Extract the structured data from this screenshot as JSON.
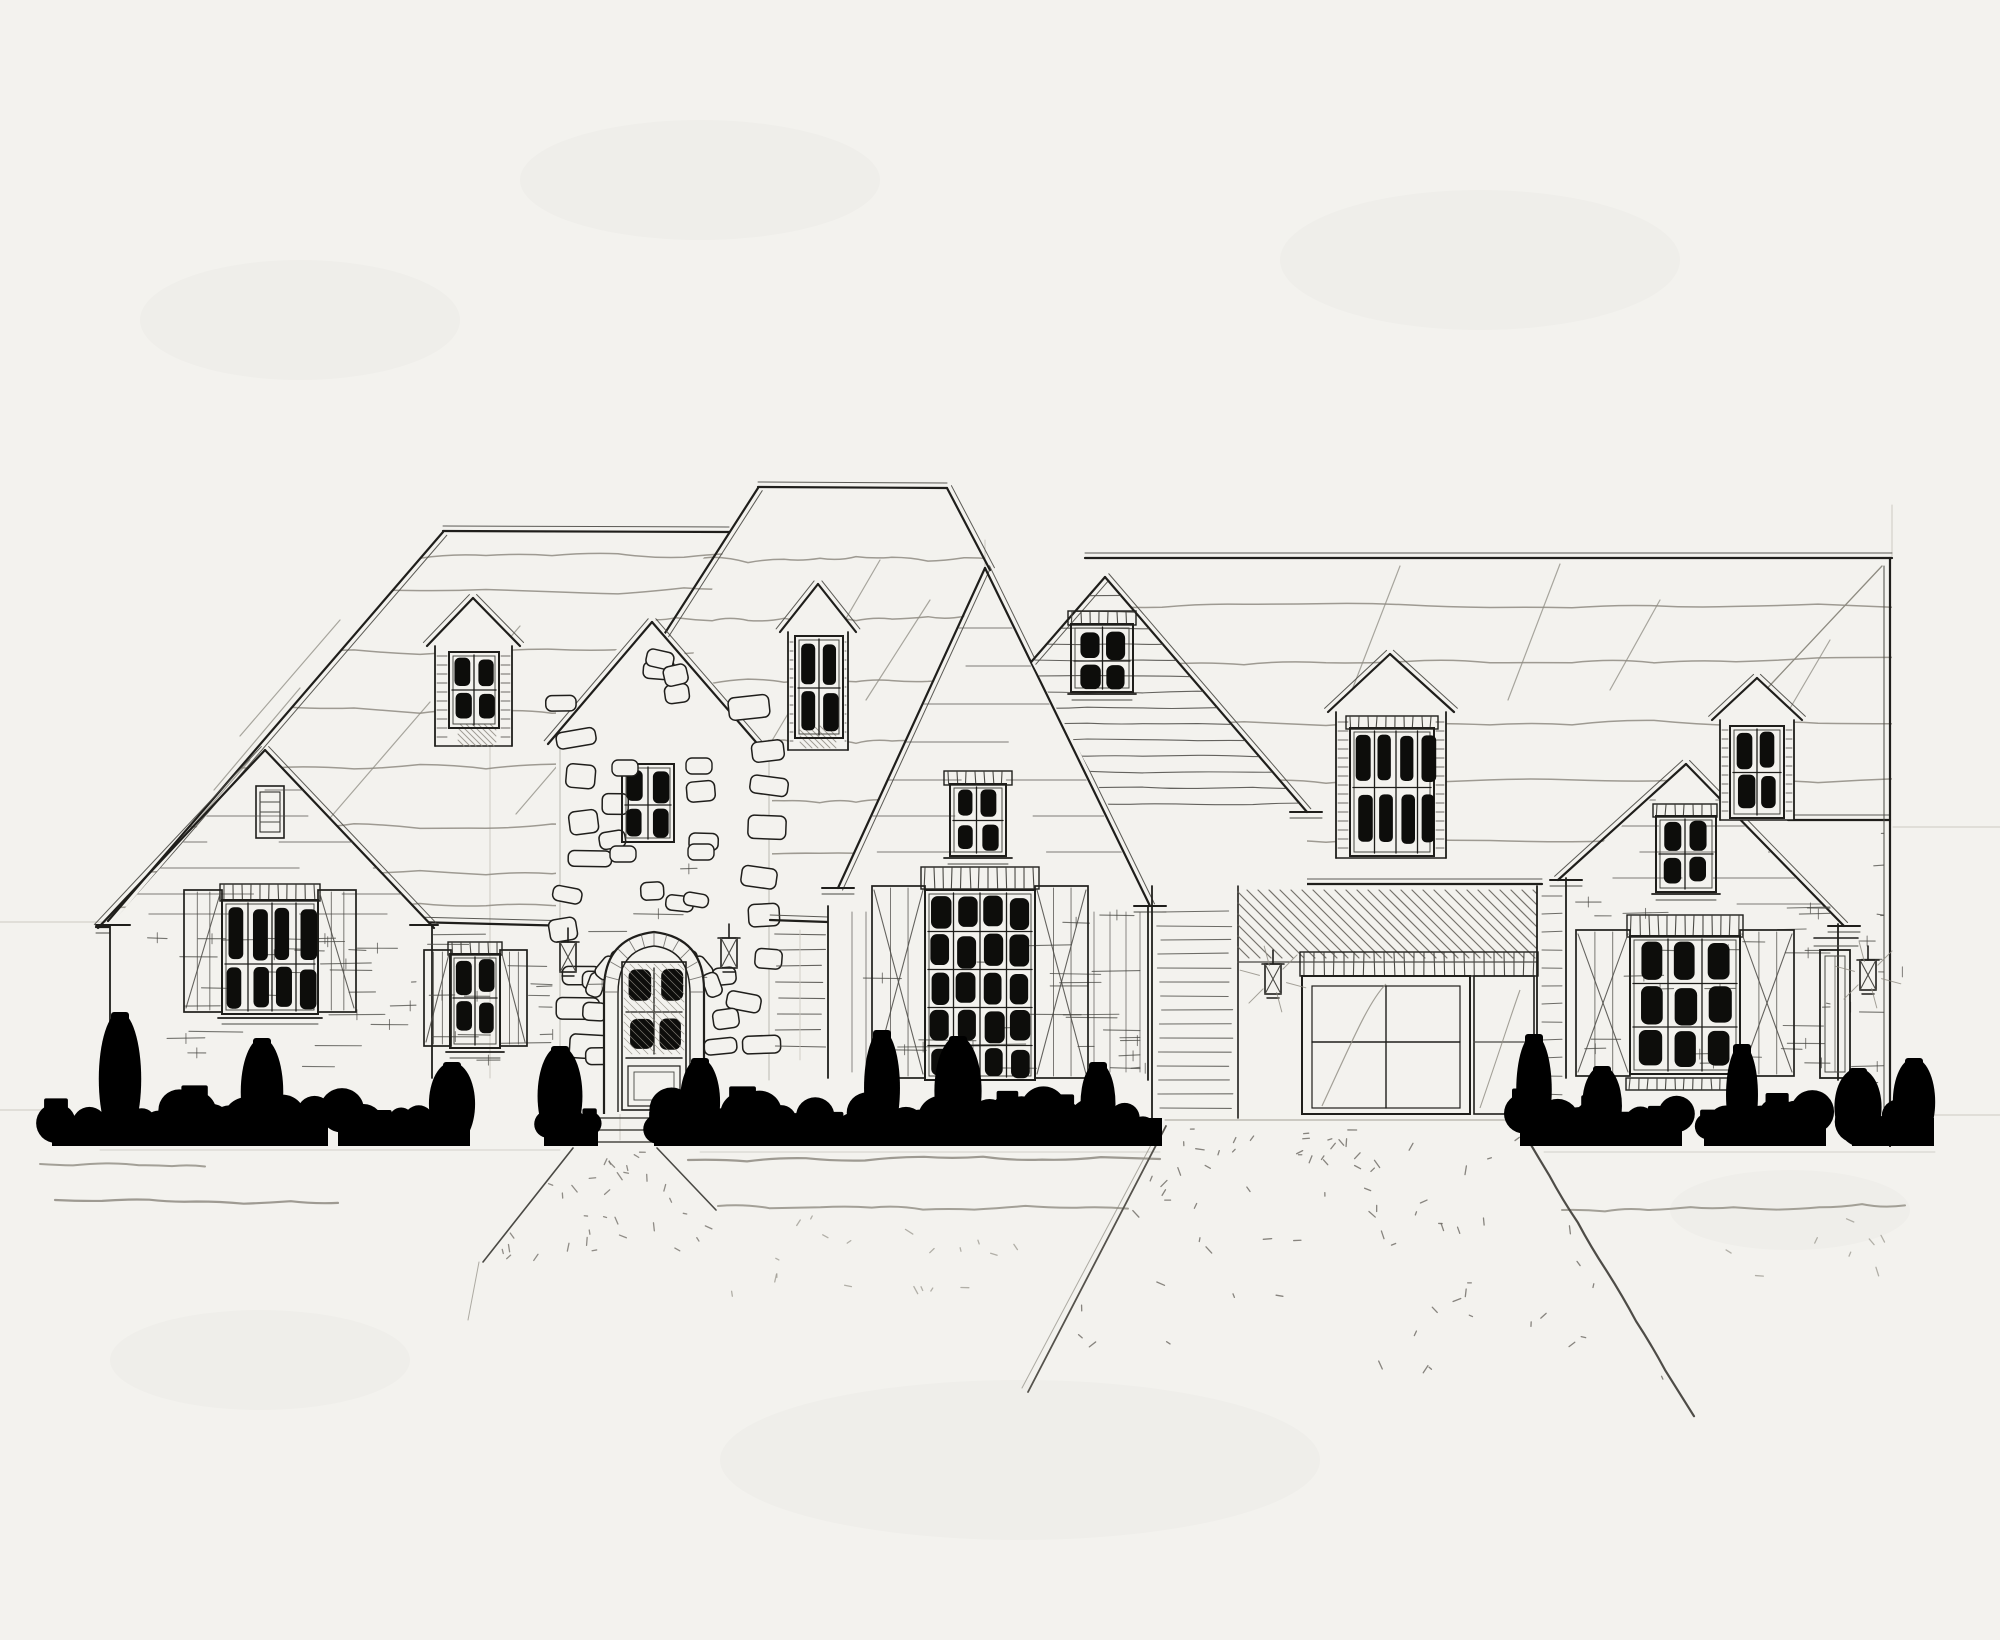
{
  "scene": {
    "type": "architectural-elevation-sketch",
    "medium": "ink and pencil on paper",
    "description": "Hand-drawn front elevation sketch of a French-country style single-family house with a central stone entry tower and arched front door, four gabled sections, five roof dormers, shuttered multi-pane windows, a recessed two-car garage, dark inked shrub masses along the foundation, a flared front walkway and a flared gravel driveway.",
    "paper_color": "#f3f2ee",
    "ink_color": "#1f1e1b",
    "pencil_color": "#8e8b81",
    "foliage_color": "#0b0b09"
  },
  "palette": {
    "paper": "#f3f2ee",
    "ink": "#1f1e1b",
    "ink_light": "#4a4944",
    "pencil": "#8e8b81",
    "faint_guide": "#c8c5bd",
    "pane_dark": "#0d0d0b",
    "hatch": "#5f5c55"
  },
  "elements": {
    "roofs": [
      {
        "name": "left-wing-roof",
        "feature": "low ridge with long raking edge, wavy shingle lines, two narrow dormers"
      },
      {
        "name": "main-center-roof",
        "feature": "tallest ridge behind stone tower"
      },
      {
        "name": "right-wing-roof",
        "feature": "long ridge over garage wing with hip crease at right end"
      }
    ],
    "sections": [
      {
        "name": "left-gable",
        "windows": [
          "attic-vent",
          "4x2-pane shuttered window"
        ]
      },
      {
        "name": "left-inner-wall",
        "windows": [
          "2x2-pane shuttered window"
        ],
        "fixtures": [
          "lantern-sconce"
        ]
      },
      {
        "name": "stone-entry-tower",
        "windows": [
          "2x2-pane stone-trimmed window"
        ],
        "door": "arched 4-lite front door with stone voussoirs",
        "fixtures": [
          "lantern-sconce",
          "lantern-sconce"
        ]
      },
      {
        "name": "center-gable",
        "windows": [
          "2x2-pane attic window",
          "4x5-pane shuttered picture window"
        ]
      },
      {
        "name": "tall-rear-gable",
        "windows": [
          "2x2-pane attic window"
        ],
        "siding": "horizontal lap siding"
      },
      {
        "name": "garage-bay",
        "door": "recessed paneled two-car garage door with shadow hatch",
        "fixtures": [
          "lantern-sconce"
        ]
      },
      {
        "name": "right-gable",
        "windows": [
          "2x2-pane attic window",
          "3x3-pane shuttered window"
        ],
        "door": "narrow side door",
        "fixtures": [
          "lantern-sconce"
        ]
      }
    ],
    "dormers": [
      {
        "name": "left-roof-dormer-1",
        "panes": "2x2"
      },
      {
        "name": "left-roof-dormer-2",
        "panes": "2x2"
      },
      {
        "name": "garage-dormer",
        "panes": "4x2"
      },
      {
        "name": "right-roof-dormer",
        "panes": "2x2"
      }
    ],
    "landscape": {
      "shrub_clusters": 6,
      "walkway": "flared front walk with speckled texture and three steps",
      "driveway": "flared driveway with speckled gravel texture",
      "lawn_lines": 5
    }
  }
}
